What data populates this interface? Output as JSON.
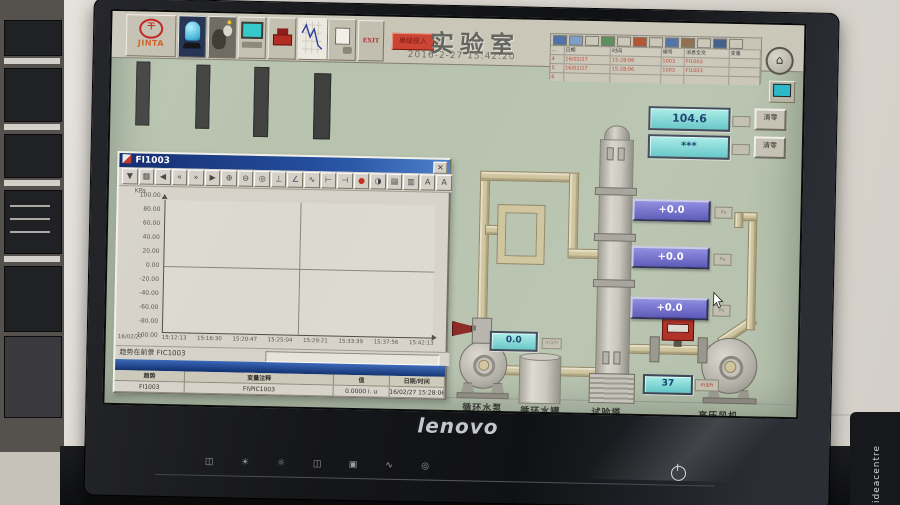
{
  "monitor": {
    "brand": "lenovo",
    "side_text": "ideacentre",
    "osd_icons": [
      {
        "name": "input-source-icon",
        "glyph": "◫"
      },
      {
        "name": "brightness-up-icon",
        "glyph": "☀"
      },
      {
        "name": "brightness-down-icon",
        "glyph": "☼"
      },
      {
        "name": "image-mode-icon",
        "glyph": "◫"
      },
      {
        "name": "menu-icon",
        "glyph": "▣"
      },
      {
        "name": "auto-adjust-icon",
        "glyph": "∿"
      },
      {
        "name": "exit-osd-icon",
        "glyph": "◎"
      }
    ]
  },
  "hmi": {
    "toolbar": {
      "logo": "JINTA",
      "logo_mark": "干",
      "exit": "EXIT",
      "entry_button": "串级投入"
    },
    "title": "实验室",
    "datetime": "2016-2-27 15:42:20",
    "home_glyph": "⌂",
    "alarm_panel": {
      "corner": "...",
      "columns": [
        "日期",
        "时间",
        "编号",
        "消息全文",
        "变量"
      ],
      "toolbar_icons": [
        {
          "name": "alarm-ack-icon",
          "color": "#4a6fa5"
        },
        {
          "name": "alarm-ack-all-icon",
          "color": "#7a9cc6"
        },
        {
          "name": "alarm-list-icon",
          "color": "#c9c6b7"
        },
        {
          "name": "alarm-ok-icon",
          "color": "#5a8a5a"
        },
        {
          "name": "alarm-print-icon",
          "color": "#c9c6b7"
        },
        {
          "name": "alarm-stop-icon",
          "color": "#b05030"
        },
        {
          "name": "alarm-filter-icon",
          "color": "#c9c6b7"
        },
        {
          "name": "alarm-archive-icon",
          "color": "#4a6fa5"
        },
        {
          "name": "alarm-log-icon",
          "color": "#8a6a4a"
        },
        {
          "name": "alarm-help-icon",
          "color": "#c9c6b7"
        },
        {
          "name": "alarm-lock-icon",
          "color": "#3a5a8a"
        },
        {
          "name": "alarm-info-icon",
          "color": "#c9c6b7"
        }
      ],
      "rows": [
        {
          "no": "4",
          "date": "16/02/27",
          "time": "15:28:06",
          "id": "1003",
          "text": "FI1003",
          "var": ""
        },
        {
          "no": "5",
          "date": "16/02/27",
          "time": "15:28:06",
          "id": "1003",
          "text": "FI1003",
          "var": ""
        },
        {
          "no": "6",
          "date": "",
          "time": "",
          "id": "",
          "text": "",
          "var": ""
        }
      ]
    }
  },
  "trend": {
    "title": "FI1003",
    "close_glyph": "×",
    "y_unit": "KPa",
    "y_ticks": [
      "100.00",
      "80.00",
      "60.00",
      "40.00",
      "20.00",
      "0.00",
      "-20.00",
      "-40.00",
      "-60.00",
      "-80.00",
      "-100.00"
    ],
    "x_date": "16/02/27",
    "x_ticks": [
      "15:12:13",
      "15:16:30",
      "15:20:47",
      "15:25:04",
      "15:29:21",
      "15:33:39",
      "15:37:56",
      "15:42:13"
    ],
    "status": "趋势在前景 FIC1003",
    "toolbar_icons": [
      {
        "name": "pin-icon",
        "glyph": "▼"
      },
      {
        "name": "save-icon",
        "glyph": "▦"
      },
      {
        "name": "first-record-icon",
        "glyph": "◀"
      },
      {
        "name": "rewind-icon",
        "glyph": "«"
      },
      {
        "name": "forward-icon",
        "glyph": "»"
      },
      {
        "name": "last-record-icon",
        "glyph": "▶"
      },
      {
        "name": "zoom-in-icon",
        "glyph": "⊕"
      },
      {
        "name": "zoom-out-icon",
        "glyph": "⊖"
      },
      {
        "name": "zoom-reset-icon",
        "glyph": "◎"
      },
      {
        "name": "axis-icon",
        "glyph": "⊥"
      },
      {
        "name": "ruler-icon",
        "glyph": "∠"
      },
      {
        "name": "curve-select-icon",
        "glyph": "∿"
      },
      {
        "name": "range-start-icon",
        "glyph": "⊢"
      },
      {
        "name": "range-end-icon",
        "glyph": "⊣"
      },
      {
        "name": "stop-icon",
        "glyph": "●",
        "color": "#c03020"
      },
      {
        "name": "pause-icon",
        "glyph": "◑"
      },
      {
        "name": "grid-icon",
        "glyph": "▤"
      },
      {
        "name": "legend-icon",
        "glyph": "▥"
      },
      {
        "name": "font-large-icon",
        "glyph": "A"
      },
      {
        "name": "font-small-icon",
        "glyph": "A"
      }
    ],
    "table": {
      "headers": [
        "趋势",
        "变量注释",
        "值",
        "日期/时间"
      ],
      "row": [
        "FI1003",
        "FI\\PIC1003",
        "0.0000 i. u",
        "16/02/27 15:28:06"
      ]
    }
  },
  "displays": {
    "totalizer1": "104.6",
    "totalizer2": "***",
    "clear_label": "清零",
    "pressures": [
      "+0.0",
      "+0.0",
      "+0.0"
    ],
    "pressure_unit": "Pa",
    "pump_flow": "0.0",
    "pump_flow_unit": "m3/h",
    "air_flow": "37",
    "air_flow_unit": "m3/h"
  },
  "equipment": {
    "pump": "循环水泵",
    "tank": "循环水罐",
    "tower": "试验塔",
    "fan": "高压风机"
  }
}
